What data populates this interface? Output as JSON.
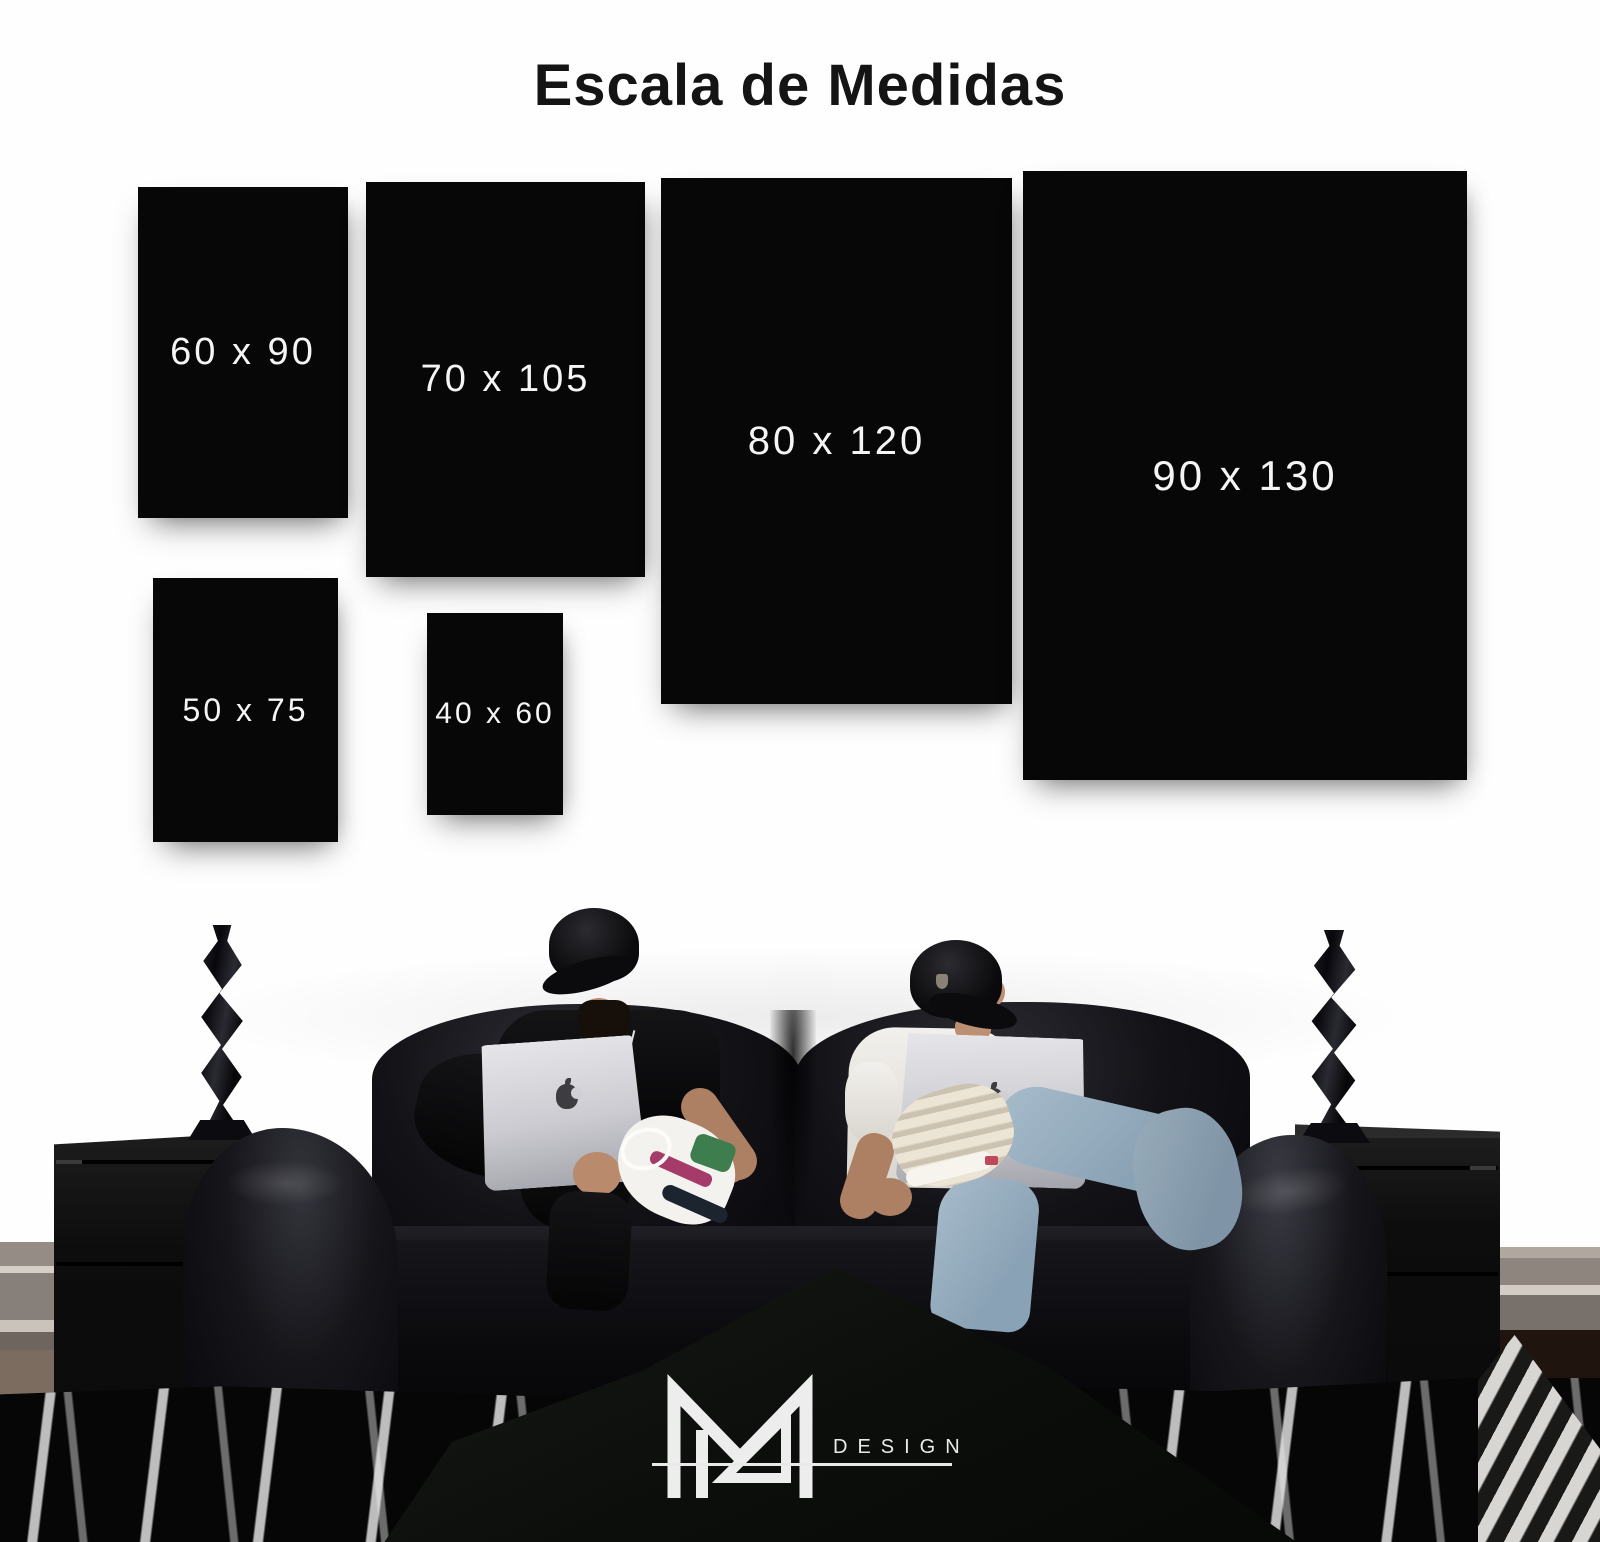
{
  "title": "Escala de Medidas",
  "sizes": [
    {
      "label": "60 x 90",
      "width_cm": 60,
      "height_cm": 90
    },
    {
      "label": "70 x 105",
      "width_cm": 70,
      "height_cm": 105
    },
    {
      "label": "80 x 120",
      "width_cm": 80,
      "height_cm": 120
    },
    {
      "label": "90 x 130",
      "width_cm": 90,
      "height_cm": 130
    },
    {
      "label": "50 x 75",
      "width_cm": 50,
      "height_cm": 75
    },
    {
      "label": "40 x 60",
      "width_cm": 40,
      "height_cm": 60
    }
  ],
  "brand": {
    "monogram_letter": "M",
    "design_label": "DESIGN"
  },
  "colors": {
    "background": "#fefefe",
    "size_box": "#070707",
    "size_label": "#f5f5f5",
    "title_text": "#141414",
    "logo": "#ededed"
  }
}
